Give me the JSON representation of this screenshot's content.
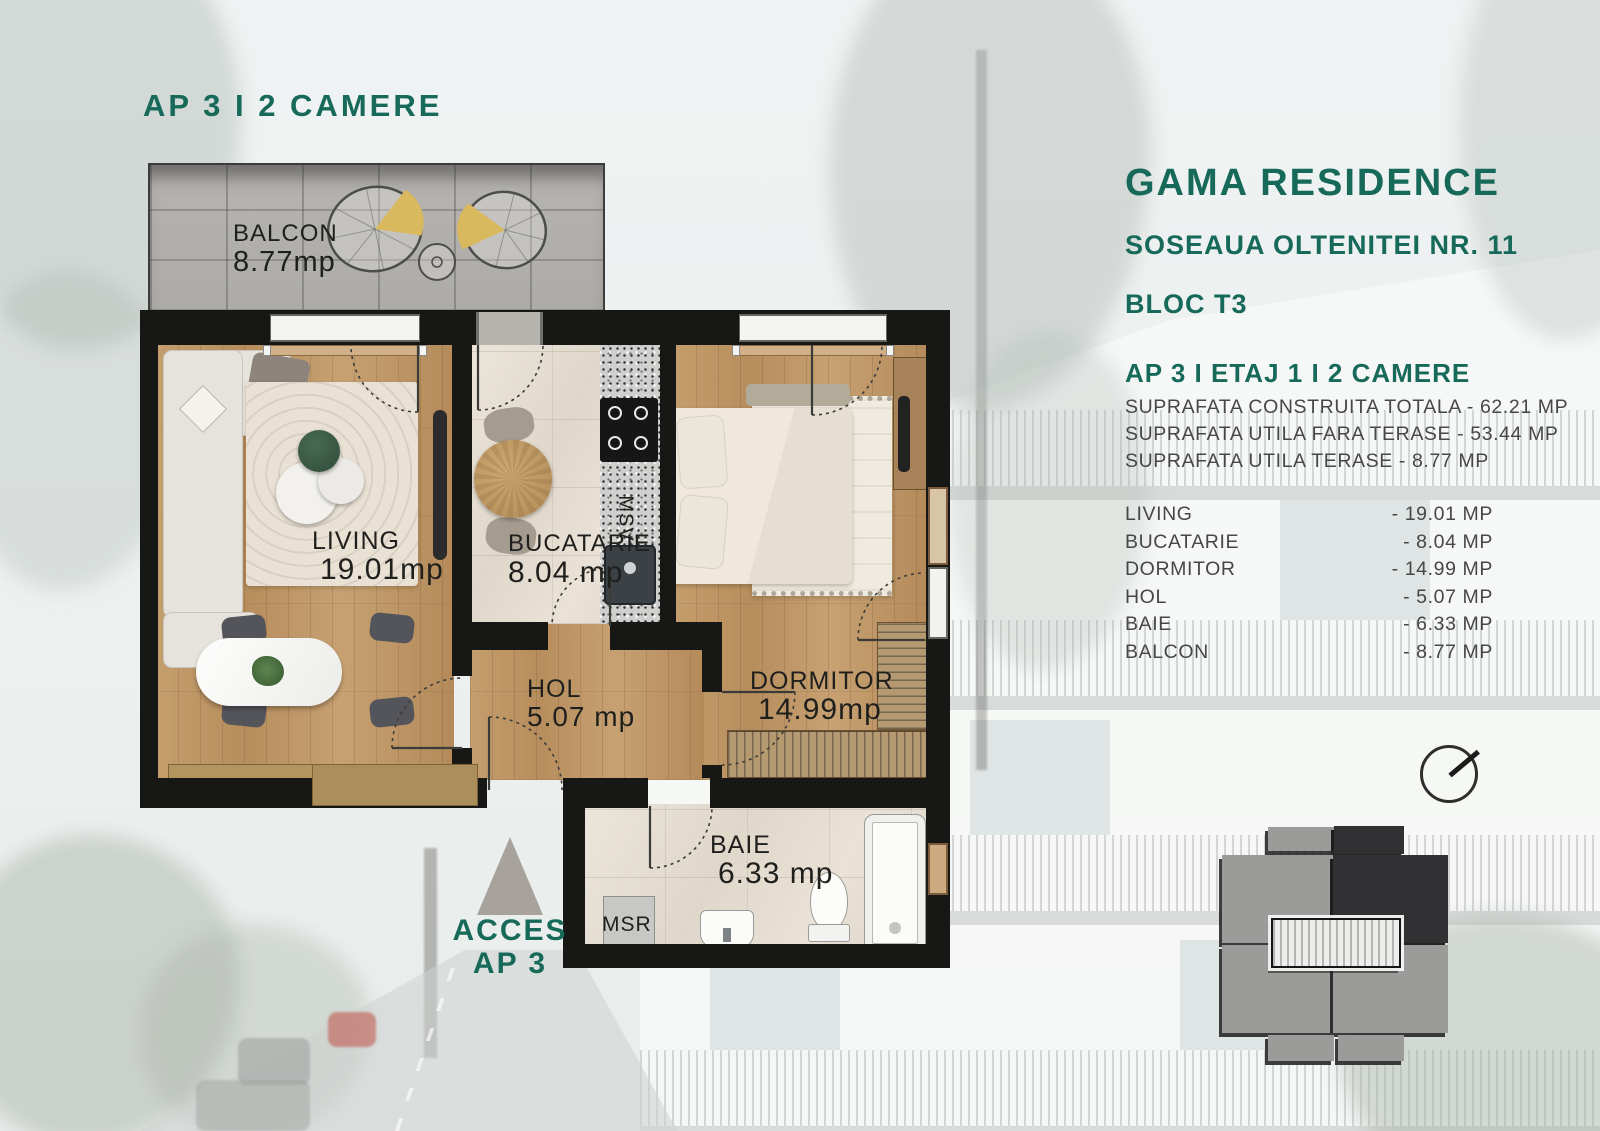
{
  "page": {
    "title": "AP 3 I 2 CAMERE"
  },
  "project": {
    "name": "GAMA RESIDENCE",
    "address": "SOSEAUA OLTENITEI NR. 11",
    "block": "BLOC T3",
    "unit": "AP 3 I ETAJ 1 I 2 CAMERE",
    "area_lines": [
      "SUPRAFATA CONSTRUITA TOTALA - 62.21 MP",
      "SUPRAFATA UTILA FARA TERASE - 53.44 MP",
      "SUPRAFATA UTILA TERASE - 8.77 MP"
    ],
    "room_table": [
      {
        "name": "LIVING",
        "value": "- 19.01 MP"
      },
      {
        "name": "BUCATARIE",
        "value": "- 8.04 MP"
      },
      {
        "name": "DORMITOR",
        "value": "- 14.99 MP"
      },
      {
        "name": "HOL",
        "value": "- 5.07 MP"
      },
      {
        "name": "BAIE",
        "value": "- 6.33 MP"
      },
      {
        "name": "BALCON",
        "value": "- 8.77 MP"
      }
    ]
  },
  "plan": {
    "rooms": {
      "balcon": {
        "name": "BALCON",
        "area": "8.77mp"
      },
      "living": {
        "name": "LIVING",
        "area": "19.01mp"
      },
      "bucatarie": {
        "name": "BUCATARIE",
        "area": "8.04 mp"
      },
      "hol": {
        "name": "HOL",
        "area": "5.07 mp"
      },
      "dormitor": {
        "name": "DORMITOR",
        "area": "14.99mp"
      },
      "baie": {
        "name": "BAIE",
        "area": "6.33 mp"
      }
    },
    "appliances": {
      "washer": "MSR",
      "dishwasher": "MSV"
    },
    "access": {
      "line1": "ACCES",
      "line2": "AP 3"
    }
  },
  "colors": {
    "accent": "#17695A",
    "wall": "#171716",
    "wood": "#C09A6B",
    "body_text": "#474745"
  }
}
